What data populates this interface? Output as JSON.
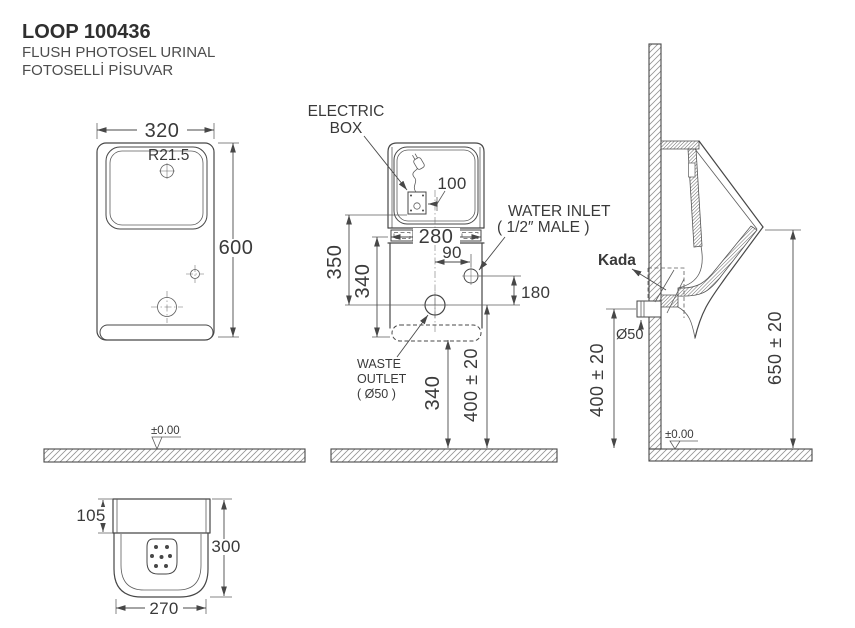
{
  "title": {
    "model": "LOOP 100436",
    "subtitle_en": "FLUSH PHOTOSEL URINAL",
    "subtitle_tr": "FOTOSELLİ PİSUVAR"
  },
  "front_view": {
    "width": "320",
    "corner_radius": "R21.5",
    "height": "600",
    "floor_level": "±0.00"
  },
  "rear_view": {
    "electric_box_line1": "ELECTRIC",
    "electric_box_line2": "BOX",
    "electric_box_offset": "100",
    "mount_width": "280",
    "water_inlet_line1": "WATER INLET",
    "water_inlet_line2": "( 1/2″ MALE )",
    "water_inlet_offset": "90",
    "water_inlet_drop": "180",
    "dim_350": "350",
    "dim_340_upper": "340",
    "waste_line1": "WASTE",
    "waste_line2": "OUTLET",
    "waste_line3": "( Ø50 )",
    "waste_height": "340",
    "install_height": "400 ± 20"
  },
  "side_view": {
    "trap": "Kada",
    "pipe_dia": "Ø50",
    "outlet_height": "400 ± 20",
    "rim_height": "650 ± 20",
    "floor_level": "±0.00"
  },
  "plan_view": {
    "spud_depth": "105",
    "depth": "300",
    "width": "270"
  },
  "colors": {
    "line": "#474747",
    "text": "#3a3a3a",
    "background": "#ffffff"
  }
}
